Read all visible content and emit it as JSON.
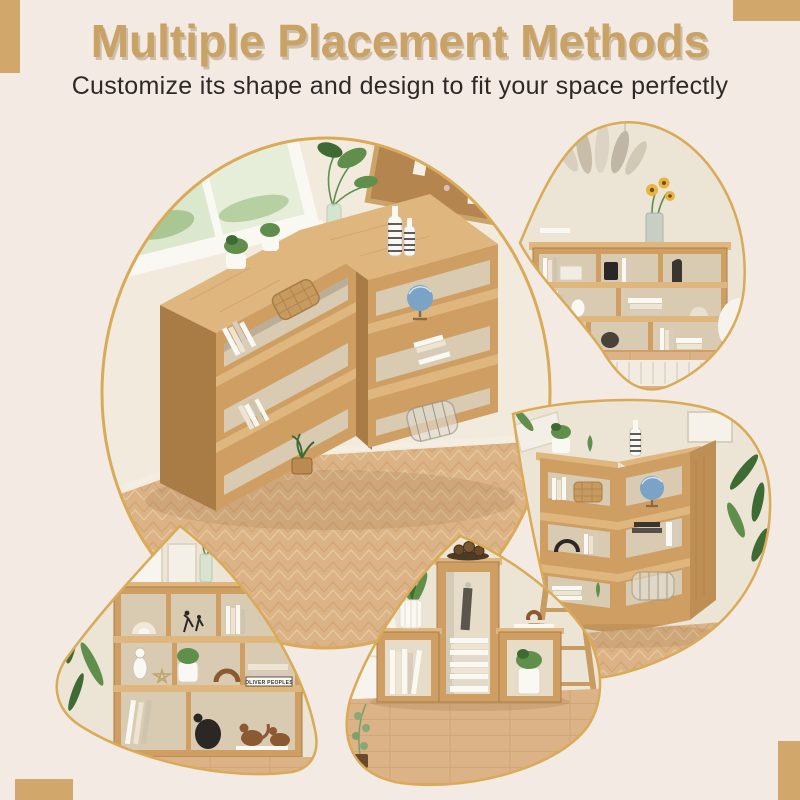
{
  "header": {
    "title": "Multiple Placement Methods",
    "subtitle": "Customize its shape and design to fit your space perfectly"
  },
  "decor_text": {
    "book_spine": "OLIVER PEOPLES"
  },
  "palette": {
    "bg": "#F3EAE3",
    "accent": "#C9A265",
    "gold": "#D9AA58",
    "ink": "#2D2927",
    "wall": "#ECE4D5",
    "wallLight": "#F1EADD",
    "wood": "#CE9E63",
    "woodTop": "#DFB67E",
    "woodDark": "#A97C46",
    "interior": "#D9CBB2",
    "floor": "#DCB386",
    "floorLight": "#EACFA4",
    "floorDark": "#C89A63",
    "green": "#5F8F4B",
    "greenDark": "#3E6B33",
    "white": "#FAF8F3",
    "cream": "#EDE4D3",
    "black": "#2B2724",
    "cork": "#B5854F",
    "blue": "#7AA3C6",
    "bronze": "#8B5A33",
    "yellow": "#E6B53C"
  },
  "photos": [
    {
      "name": "corner-bookcase-top-view",
      "shape": "large-circle"
    },
    {
      "name": "wide-bookcase-row",
      "shape": "top-right-petal"
    },
    {
      "name": "corner-bookcase-front-view",
      "shape": "right-petal"
    },
    {
      "name": "staggered-bookcase",
      "shape": "bottom-left-fan"
    },
    {
      "name": "staircase-cube-bookcase",
      "shape": "bottom-center-petal"
    }
  ]
}
